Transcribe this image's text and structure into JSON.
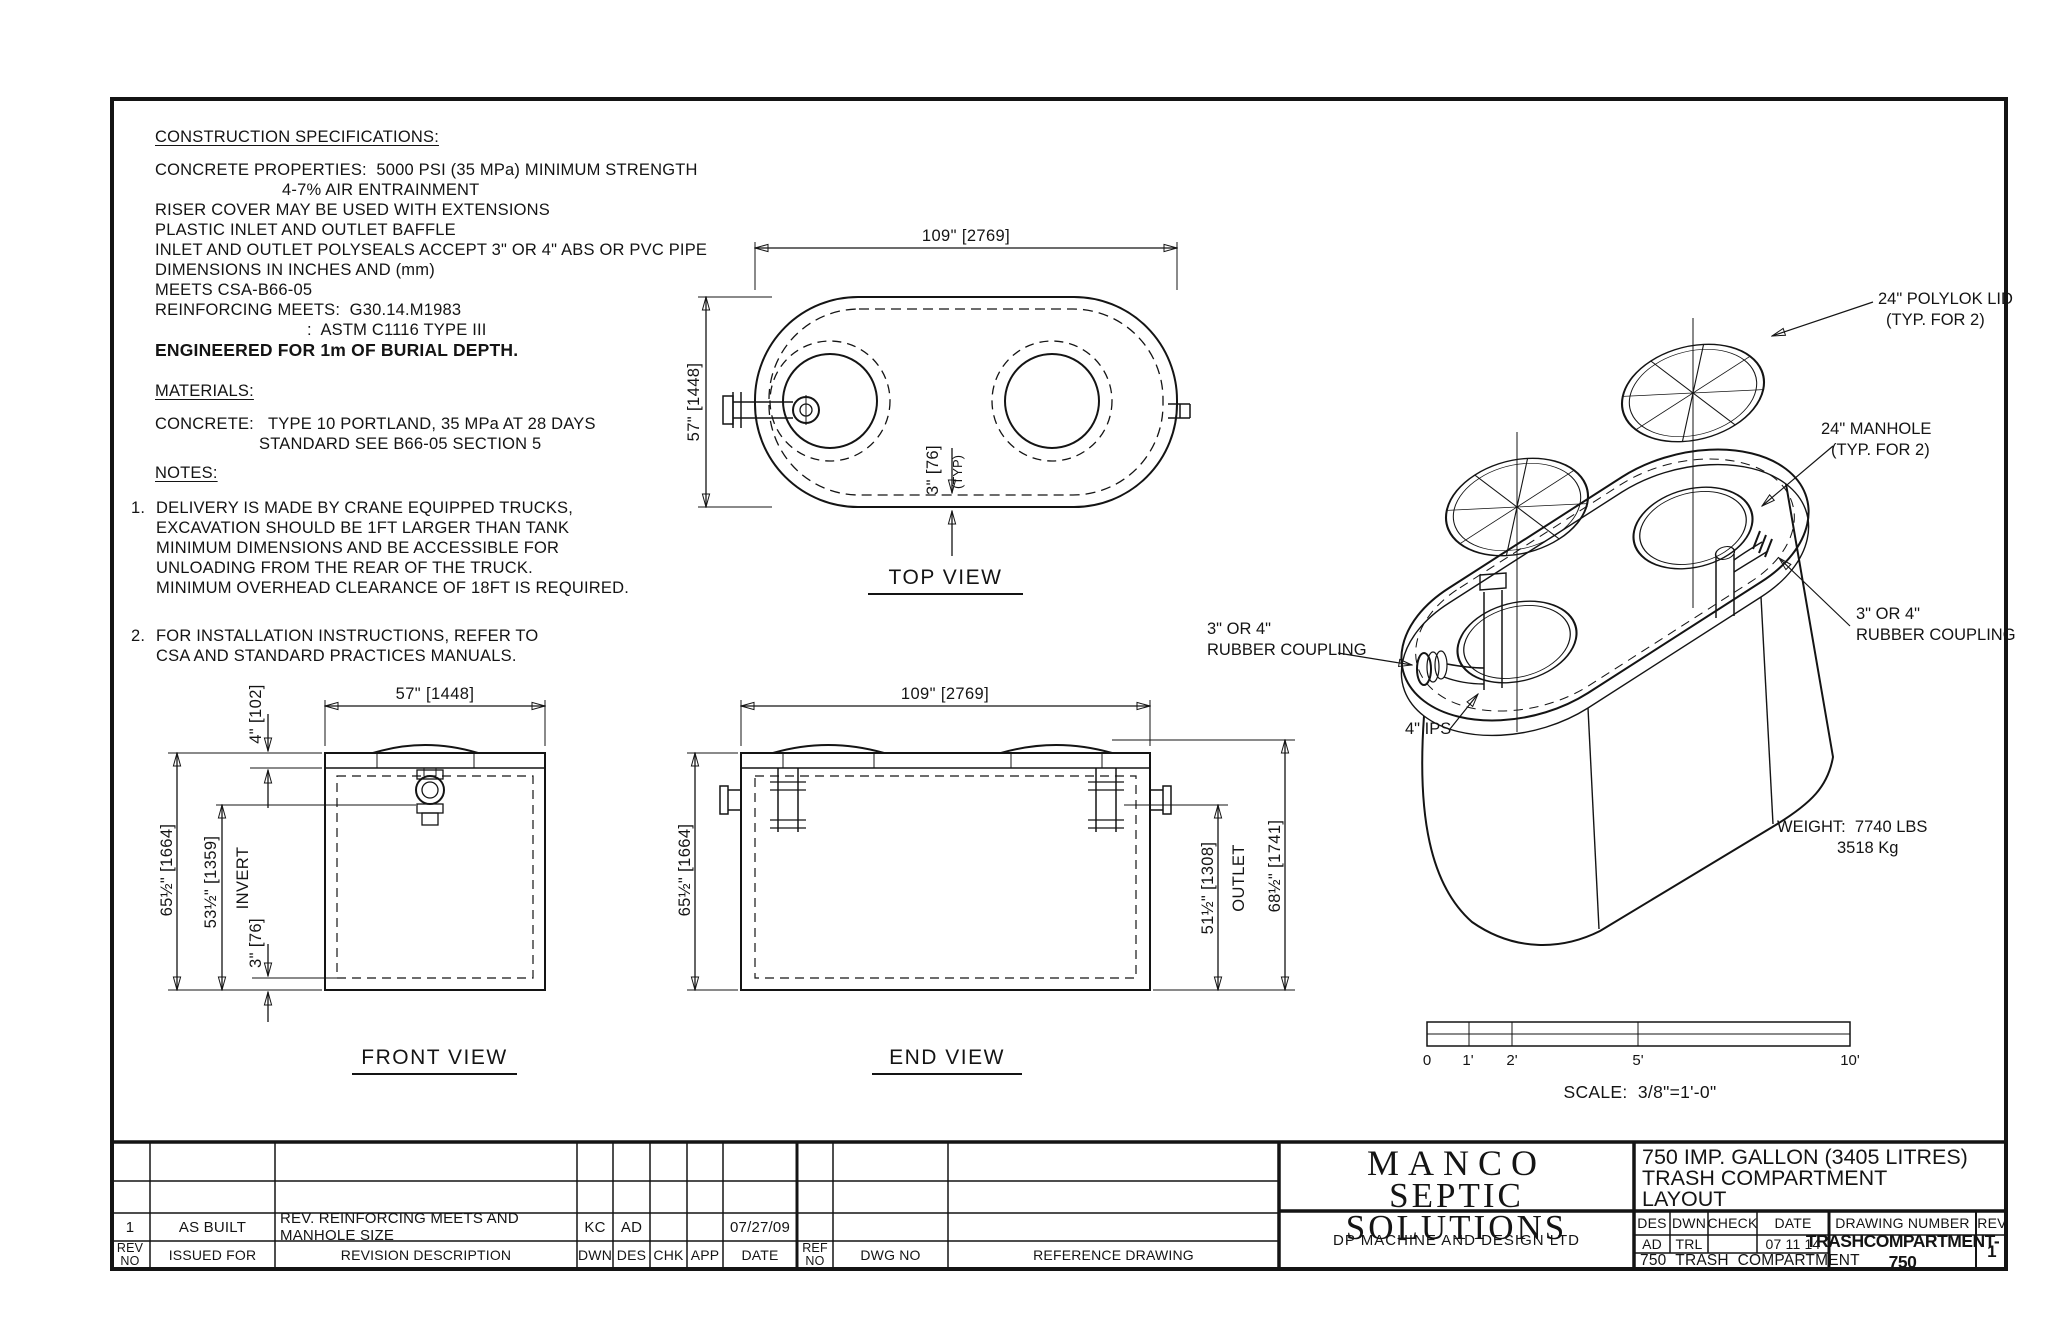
{
  "specs": {
    "heading": "CONSTRUCTION SPECIFICATIONS:",
    "l0": "CONCRETE PROPERTIES:  5000 PSI (35 MPa) MINIMUM STRENGTH",
    "l1": "4-7% AIR ENTRAINMENT",
    "l2": "RISER COVER MAY BE USED WITH EXTENSIONS",
    "l3": "PLASTIC INLET AND OUTLET BAFFLE",
    "l4": "INLET AND OUTLET POLYSEALS ACCEPT 3\" OR 4\" ABS OR PVC PIPE",
    "l5": "DIMENSIONS IN INCHES AND (mm)",
    "l6": "MEETS CSA-B66-05",
    "l7": "REINFORCING MEETS:  G30.14.M1983",
    "l8": ":  ASTM C1116 TYPE III",
    "l9": "ENGINEERED FOR 1m OF BURIAL DEPTH."
  },
  "materials": {
    "heading": "MATERIALS:",
    "l1": "CONCRETE:   TYPE 10 PORTLAND, 35 MPa AT 28 DAYS",
    "l2": "STANDARD SEE B66-05 SECTION 5"
  },
  "notes": {
    "heading": "NOTES:",
    "n1num": "1.",
    "n1a": "DELIVERY IS MADE BY CRANE EQUIPPED TRUCKS,",
    "n1b": "EXCAVATION SHOULD BE 1FT LARGER THAN TANK",
    "n1c": "MINIMUM DIMENSIONS AND BE ACCESSIBLE FOR",
    "n1d": "UNLOADING FROM THE REAR OF THE TRUCK.",
    "n1e": "MINIMUM OVERHEAD CLEARANCE OF 18FT IS REQUIRED.",
    "n2num": "2.",
    "n2a": "FOR INSTALLATION INSTRUCTIONS, REFER TO",
    "n2b": "CSA AND STANDARD PRACTICES MANUALS."
  },
  "top_view": {
    "title": "TOP VIEW",
    "dim_width": "109\" [2769]",
    "dim_height": "57\" [1448]",
    "dim_wall": "3\" [76]",
    "dim_wall_typ": "(TYP)"
  },
  "front_view": {
    "title": "FRONT VIEW",
    "dim_width": "57\" [1448]",
    "dim_slab": "4\" [102]",
    "dim_height": "65½\" [1664]",
    "dim_invert": "53½\" [1359]",
    "invert_label": "INVERT",
    "dim_floor": "3\" [76]"
  },
  "end_view": {
    "title": "END VIEW",
    "dim_width": "109\" [2769]",
    "dim_height": "65½\" [1664]",
    "dim_outlet": "51½\" [1308]",
    "outlet_label": "OUTLET",
    "dim_overall": "68½\" [1741]"
  },
  "iso": {
    "lid_1": "24\" POLYLOK LID",
    "lid_2": "(TYP. FOR 2)",
    "manhole_1": "24\" MANHOLE",
    "manhole_2": "(TYP. FOR 2)",
    "coupling_r1": "3\" OR 4\"",
    "coupling_r2": "RUBBER COUPLING",
    "coupling_l1": "3\" OR 4\"",
    "coupling_l2": "RUBBER COUPLING",
    "ips": "4\" IPS",
    "weight_1": "WEIGHT:  7740 LBS",
    "weight_2": "3518 Kg"
  },
  "scalebar": {
    "t0": "0",
    "t1": "1'",
    "t2": "2'",
    "t5": "5'",
    "t10": "10'",
    "scale_text": "SCALE:  3/8\"=1'-0\""
  },
  "titleblock": {
    "company_1": "MANCO",
    "company_2": "SEPTIC SOLUTIONS",
    "firm": "DP MACHINE AND DESIGN LTD",
    "product_1": "750 IMP. GALLON (3405 LITRES)",
    "product_2": "TRASH COMPARTMENT",
    "product_3": "LAYOUT",
    "hdr": {
      "rev_no_1": "REV",
      "rev_no_2": "NO",
      "issued_for": "ISSUED FOR",
      "description": "REVISION DESCRIPTION",
      "dwn": "DWN",
      "des": "DES",
      "chk": "CHK",
      "app": "APP",
      "date": "DATE",
      "ref_no_1": "REF",
      "ref_no_2": "NO",
      "dwg_no": "DWG NO",
      "reference_drawing": "REFERENCE DRAWING"
    },
    "rev1": {
      "rev_no": "1",
      "issued_for": "AS BUILT",
      "description": "REV. REINFORCING MEETS AND MANHOLE SIZE",
      "dwn": "KC",
      "des": "AD",
      "chk": "",
      "app": "",
      "date": "07/27/09"
    },
    "des_hdr": {
      "des": "DES",
      "dwn": "DWN",
      "check": "CHECK",
      "date": "DATE"
    },
    "des_val": {
      "des": "AD",
      "dwn": "TRL",
      "check": "",
      "date": "07 11 14"
    },
    "filename": "750_TRASH_COMPARTMENT",
    "drawing_number_label": "DRAWING NUMBER",
    "drawing_number": "TRASHCOMPARTMENT-750",
    "rev_label": "REV",
    "rev_value": "1"
  }
}
